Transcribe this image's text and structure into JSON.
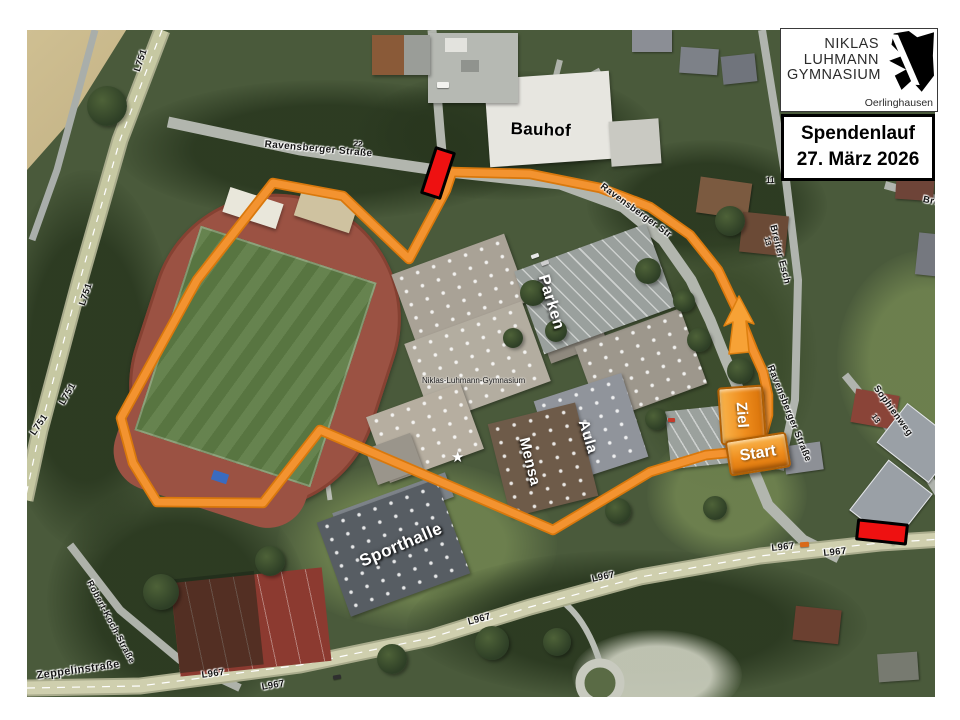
{
  "logo_card": {
    "school_name_lines": [
      "NIKLAS",
      "LUHMANN",
      "GYMNASIUM"
    ],
    "town": "Oerlinghausen"
  },
  "event_card": {
    "title": "Spendenlauf",
    "date": "27. März 2026"
  },
  "route": {
    "start_label": "Start",
    "finish_label": "Ziel",
    "accent_color": "#ef8d1d",
    "closure_color": "#ee1111"
  },
  "map_labels": [
    {
      "name": "street-ravensberger-top",
      "text": "Ravensberger Straße",
      "kind": "street",
      "x": 238,
      "y": 110,
      "rot": 5,
      "fs": 10
    },
    {
      "name": "house-number-22",
      "text": "22",
      "kind": "sm",
      "x": 327,
      "y": 110,
      "rot": 5
    },
    {
      "name": "street-ravensberger-curve",
      "text": "Ravensberger Str",
      "kind": "street",
      "x": 577,
      "y": 152,
      "rot": 36
    },
    {
      "name": "street-ravensberger-south",
      "text": "Ravensberger Straße",
      "kind": "street",
      "x": 747,
      "y": 334,
      "rot": 68
    },
    {
      "name": "street-breiter-esch",
      "text": "Breiter Esch",
      "kind": "street",
      "x": 750,
      "y": 194,
      "rot": 76
    },
    {
      "name": "house-number-11",
      "text": "11",
      "kind": "sm",
      "x": 739,
      "y": 147,
      "rot": 0
    },
    {
      "name": "house-number-13",
      "text": "13",
      "kind": "sm",
      "x": 743,
      "y": 206,
      "rot": 76
    },
    {
      "name": "street-bre",
      "text": "Bre",
      "kind": "street",
      "x": 897,
      "y": 165,
      "rot": 12
    },
    {
      "name": "street-sophienweg",
      "text": "Sophienweg",
      "kind": "street",
      "x": 852,
      "y": 354,
      "rot": 54
    },
    {
      "name": "house-number-13b",
      "text": "13",
      "kind": "sm",
      "x": 849,
      "y": 383,
      "rot": 54
    },
    {
      "name": "ref-l751-a",
      "text": "L751",
      "kind": "street",
      "x": 106,
      "y": 40,
      "rot": -72
    },
    {
      "name": "ref-l751-b",
      "text": "L751",
      "kind": "street",
      "x": 51,
      "y": 274,
      "rot": -72
    },
    {
      "name": "ref-l751-c",
      "text": "L751",
      "kind": "street",
      "x": 31,
      "y": 372,
      "rot": -60
    },
    {
      "name": "ref-l751-d",
      "text": "L751",
      "kind": "street",
      "x": 2,
      "y": 402,
      "rot": -56
    },
    {
      "name": "ref-l967-a",
      "text": "L967",
      "kind": "street",
      "x": 440,
      "y": 588,
      "rot": -15
    },
    {
      "name": "ref-l967-b",
      "text": "L967",
      "kind": "street",
      "x": 564,
      "y": 545,
      "rot": -12
    },
    {
      "name": "ref-l967-c",
      "text": "L967",
      "kind": "street",
      "x": 744,
      "y": 514,
      "rot": -6
    },
    {
      "name": "ref-l967-d",
      "text": "L967",
      "kind": "street",
      "x": 796,
      "y": 519,
      "rot": -6
    },
    {
      "name": "ref-l967-e",
      "text": "L967",
      "kind": "street",
      "x": 174,
      "y": 641,
      "rot": -8
    },
    {
      "name": "ref-l967-f",
      "text": "L967",
      "kind": "street",
      "x": 234,
      "y": 653,
      "rot": -10
    },
    {
      "name": "street-zeppelinstrasse",
      "text": "Zeppelinstraße",
      "kind": "street",
      "x": 9,
      "y": 641,
      "rot": -8,
      "fs": 11
    },
    {
      "name": "street-robert-koch",
      "text": "Robert-Koch-Straße",
      "kind": "street",
      "x": 66,
      "y": 549,
      "rot": 62,
      "fs": 9
    },
    {
      "name": "poi-school-name",
      "text": "Niklas-Luhmann-Gymnasium",
      "kind": "tiny",
      "x": 395,
      "y": 347,
      "rot": 0
    },
    {
      "name": "poi-bauhof",
      "text": "Bauhof",
      "kind": "feature-dark",
      "x": 484,
      "y": 90,
      "rot": 2,
      "fs": 17
    },
    {
      "name": "poi-parken",
      "text": "Parken",
      "kind": "feature-white",
      "x": 523,
      "y": 243,
      "rot": 73,
      "fs": 16
    },
    {
      "name": "poi-aula",
      "text": "Aula",
      "kind": "feature-white",
      "x": 563,
      "y": 388,
      "rot": 73,
      "fs": 15
    },
    {
      "name": "poi-mensa",
      "text": "Mensa",
      "kind": "feature-white",
      "x": 504,
      "y": 406,
      "rot": 76,
      "fs": 15
    },
    {
      "name": "poi-sporthalle",
      "text": "Sporthalle",
      "kind": "feature-white",
      "x": 330,
      "y": 524,
      "rot": -23,
      "fs": 17
    }
  ]
}
